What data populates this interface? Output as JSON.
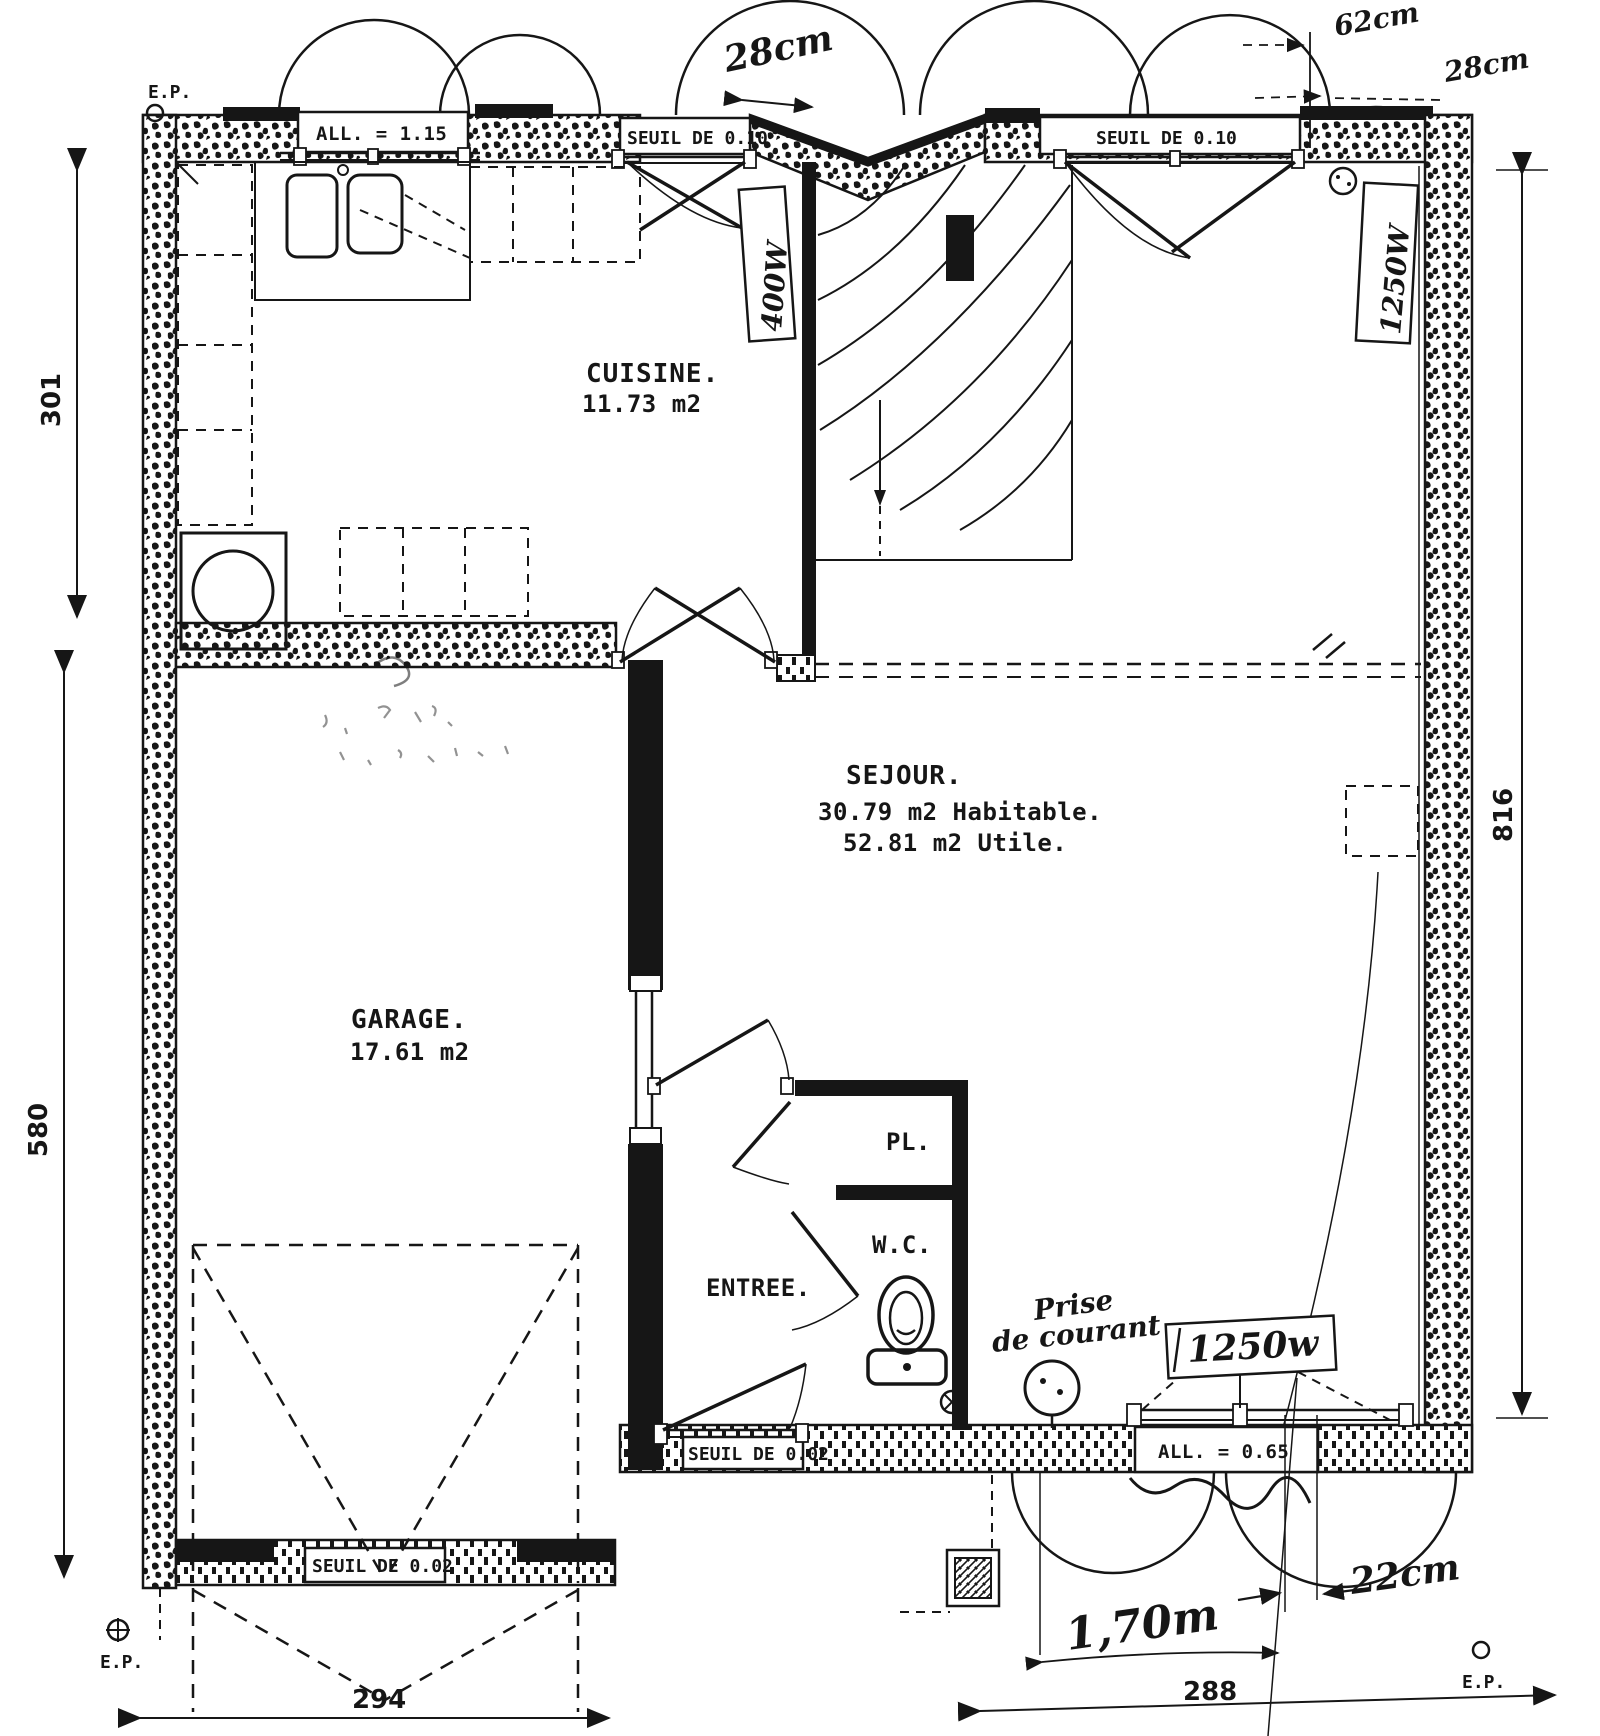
{
  "colors": {
    "paper": "#ffffff",
    "ink": "#161616"
  },
  "rooms": {
    "cuisine": {
      "name": "CUISINE.",
      "area": "11.73 m2"
    },
    "sejour": {
      "name": "SEJOUR.",
      "area_habitable": "30.79 m2 Habitable.",
      "area_utile": "52.81 m2 Utile."
    },
    "garage": {
      "name": "GARAGE.",
      "area": "17.61 m2"
    },
    "entree": {
      "name": "ENTREE."
    },
    "placard": {
      "name": "PL."
    },
    "wc": {
      "name": "W.C."
    }
  },
  "openings": {
    "window_allege_115": "ALL. = 1.15",
    "seuil_010_left": "SEUIL DE 0.10",
    "seuil_010_right": "SEUIL DE 0.10",
    "seuil_002_entry": "SEUIL DE 0.02",
    "seuil_002_garage": "SEUIL DE 0.02",
    "window_allege_065": "ALL. = 0.65"
  },
  "dimensions": {
    "left_upper": "301",
    "left_lower": "580",
    "right_side": "816",
    "bottom_left": "294",
    "bottom_right": "288"
  },
  "annotations": {
    "top_width": "28cm",
    "corner_offset": "62cm",
    "corner_width": "28cm",
    "radiator_stairs": "400W",
    "radiator_right": "1250W",
    "radiator_bottom": "1250w",
    "outlet_word1": "Prise",
    "outlet_word2": "de courant",
    "bay_width": "1,70m",
    "pier_width": "22cm"
  },
  "markers": {
    "ep_top_left": "E.P.",
    "ep_bottom_left": "E.P.",
    "ep_bottom_right": "E.P."
  }
}
